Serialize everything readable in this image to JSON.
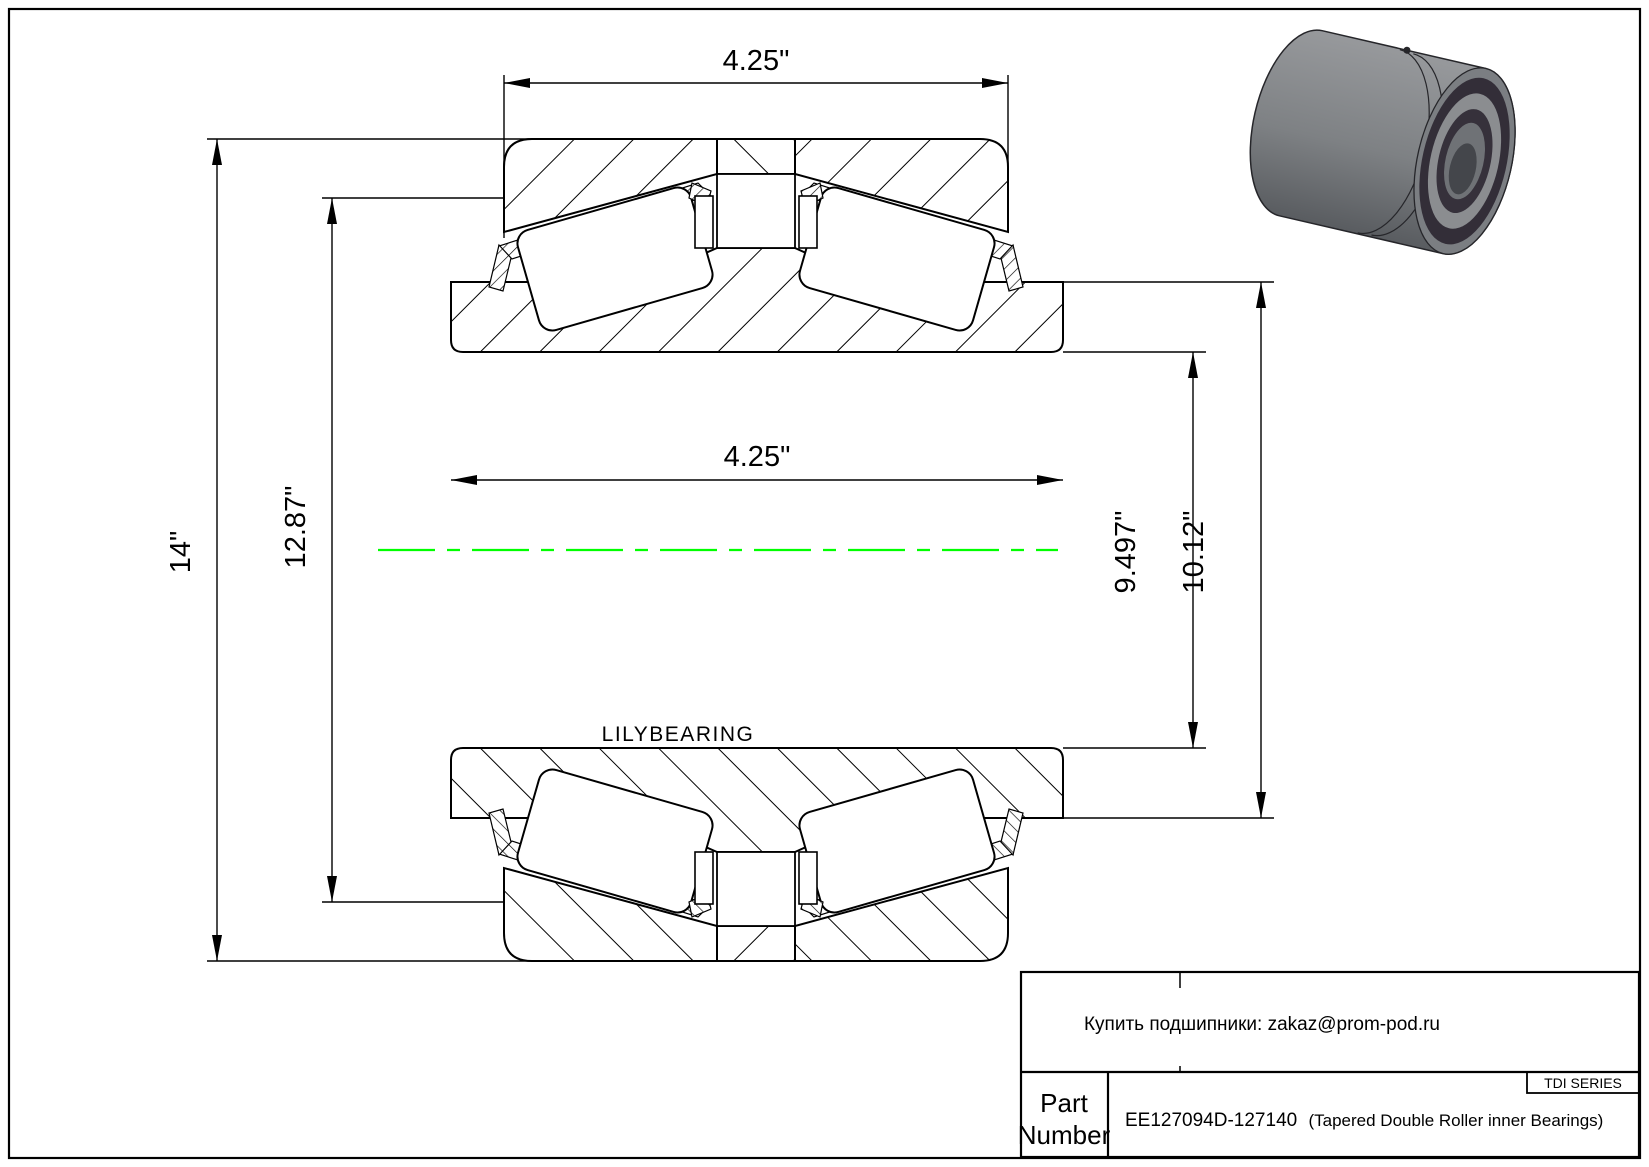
{
  "page": {
    "background": "#ffffff",
    "border_color": "#000000"
  },
  "drawing": {
    "watermark": "LILYBEARING",
    "centerline_color": "#00ff00",
    "dimensions": {
      "cup_assembly_width": "4.25\"",
      "cone_bore_width": "4.25\"",
      "outer_diameter": "14\"",
      "cup_front_diameter": "12.87\"",
      "cone_rib_diameter": "9.497\"",
      "cone_backface_diameter": "10.12\""
    }
  },
  "title_block": {
    "contact": "Купить подшипники: zakaz@prom-pod.ru",
    "series": "TDI SERIES",
    "part_label_line1": "Part",
    "part_label_line2": "Number",
    "part_number": "EE127094D-127140",
    "part_description": "(Tapered Double Roller inner Bearings)"
  }
}
